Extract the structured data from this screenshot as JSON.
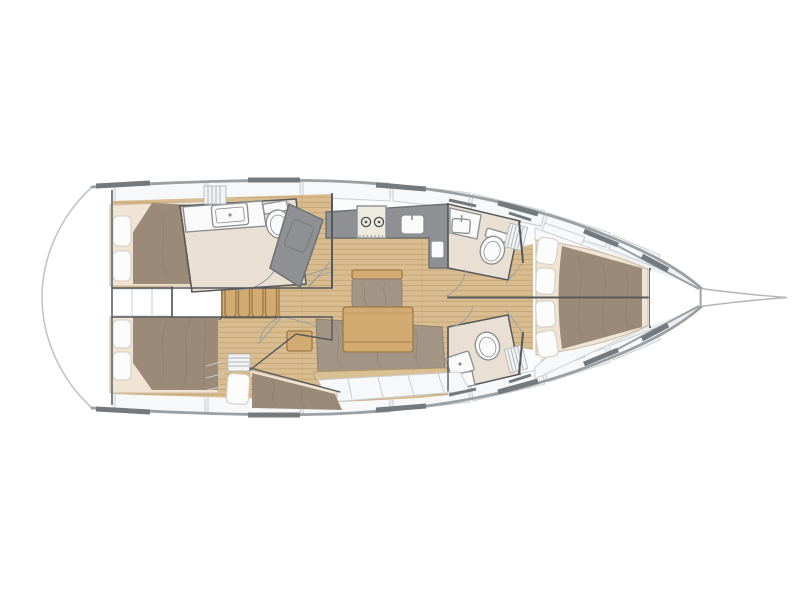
{
  "diagram": {
    "type": "sailing-yacht-interior-floor-plan",
    "view": "top-down",
    "orientation": "bow-right",
    "rooms": [
      "swim-platform",
      "aft-cabin-port",
      "aft-cabin-starboard",
      "companionway",
      "aft-head-port",
      "galley",
      "salon",
      "aft-berth-starboard",
      "forward-head-port",
      "forward-head-starboard",
      "forward-cabin",
      "foredeck"
    ],
    "fixtures": [
      "double-berth",
      "bed-pillows",
      "companionway-ladder",
      "wet-locker",
      "two-burner-stove",
      "galley-sink",
      "vanity-sink",
      "toilet",
      "shower-pan",
      "dining-table",
      "u-shaped-settee",
      "bench-seat",
      "side-table",
      "louvered-locker",
      "hull-windows",
      "bowsprit",
      "deck-lockers"
    ]
  },
  "colors": {
    "deck": "#edeff1",
    "white": "#ffffff",
    "interior": "#fbfcfc",
    "panel": "#f7f8f9",
    "panelLine": "#cbcfd2",
    "hullStroke": "#9aa0a3",
    "hullDark": "#73797d",
    "transom": "#c2c5c7",
    "wall": "#55595c",
    "thinLine": "#c8cbcd",
    "arcLine": "#9aa0a3",
    "wood": "#d9bd90",
    "woodline": "#c2a270",
    "furniture": "#d3ab72",
    "furnitureLine": "#9a7946",
    "counter": "#8e9093",
    "counterLine": "#6e7174",
    "cream": "#f0e4d4",
    "creamLine": "#cbb89d",
    "duvet": "#9c8a79",
    "wrinkle": "#84715f",
    "pillow": "#fcfcfc",
    "pillowLine": "#d5cec3",
    "settee": "#a39586",
    "setteeLine": "#8d8071",
    "trim": "#d9bf92",
    "trimLine": "#b79a68",
    "headFloor": "#eadfd3",
    "fixture": "#fafafa",
    "fixtureLine": "#8a8d90",
    "louverBg": "#f2f3f4",
    "louverLine": "#b2b6b9",
    "stove": "#edebe0"
  }
}
